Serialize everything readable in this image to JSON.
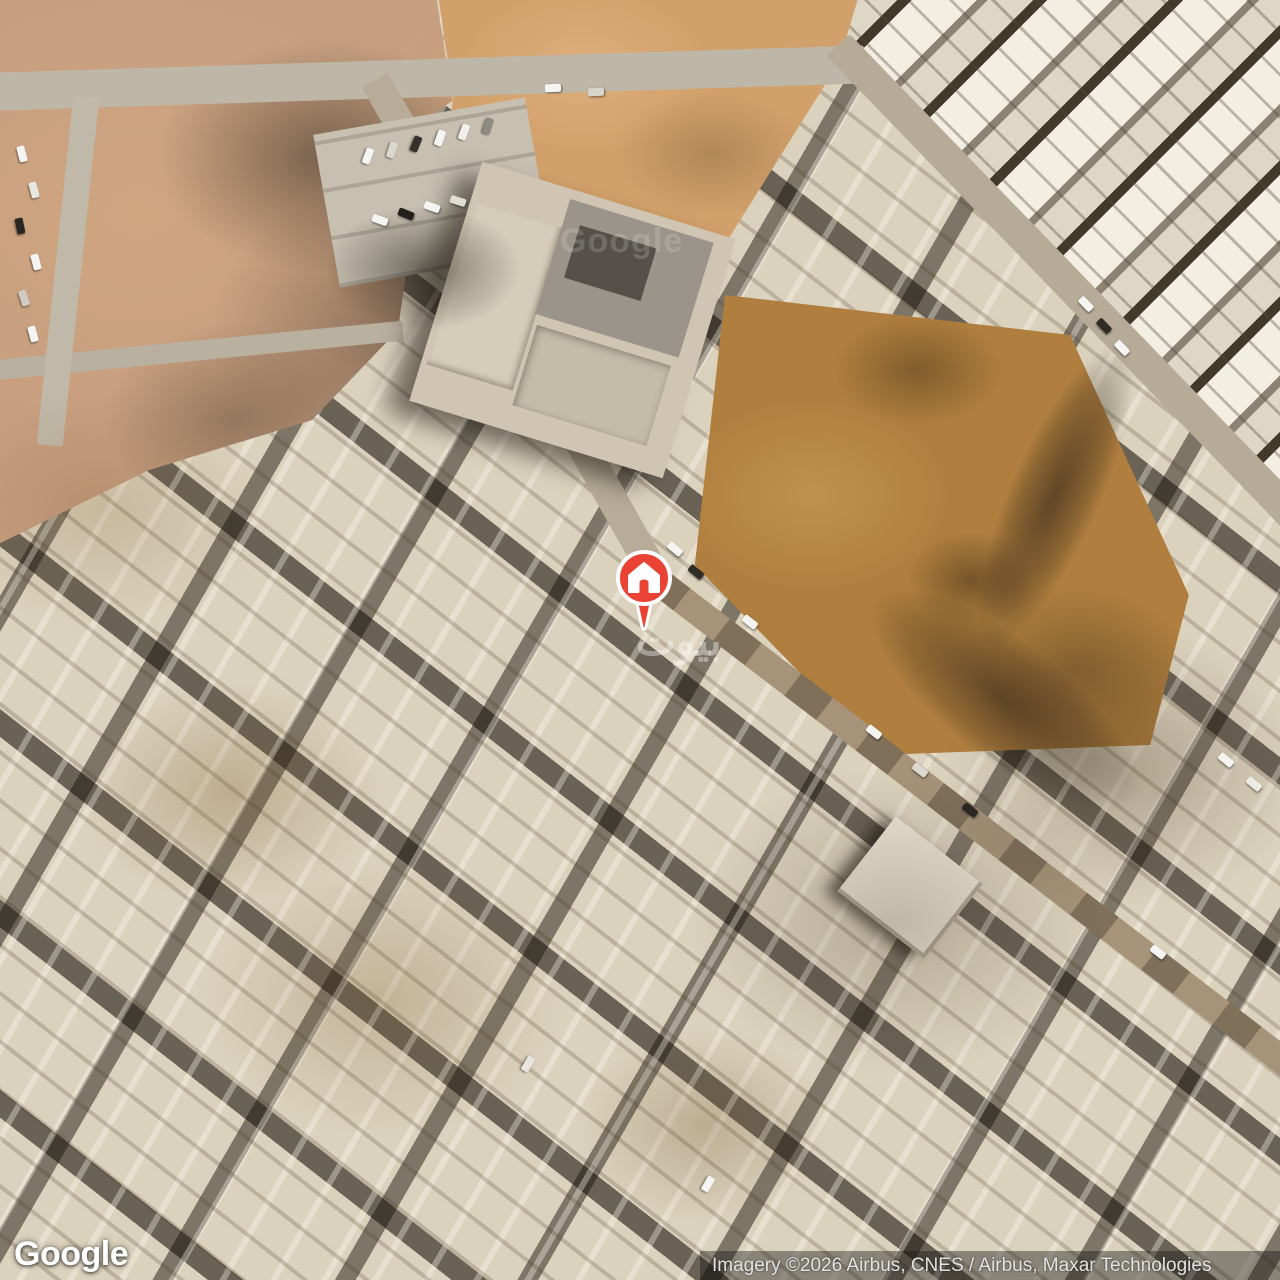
{
  "map": {
    "type": "satellite",
    "watermark": "بيوت",
    "tile_watermark": "Google"
  },
  "marker": {
    "icon": "home-pin",
    "color": "#EA4335"
  },
  "branding": {
    "logo_text": "Google"
  },
  "attribution": {
    "text": "Imagery ©2026 Airbus, CNES / Airbus, Maxar Technologies"
  },
  "decor": {
    "cars": [
      {
        "x": 14,
        "y": 150,
        "r": 75,
        "c": "#f4f4f2"
      },
      {
        "x": 26,
        "y": 186,
        "r": 75,
        "c": "#e8e6e0"
      },
      {
        "x": 12,
        "y": 222,
        "r": 78,
        "c": "#2a2722"
      },
      {
        "x": 28,
        "y": 258,
        "r": 75,
        "c": "#f4f4f2"
      },
      {
        "x": 16,
        "y": 294,
        "r": 72,
        "c": "#cfcbc2"
      },
      {
        "x": 25,
        "y": 330,
        "r": 75,
        "c": "#f4f4f2"
      },
      {
        "x": 360,
        "y": 152,
        "r": 110,
        "c": "#f4f4f2"
      },
      {
        "x": 384,
        "y": 146,
        "r": 108,
        "c": "#dad7cf"
      },
      {
        "x": 408,
        "y": 140,
        "r": 112,
        "c": "#35322c"
      },
      {
        "x": 432,
        "y": 134,
        "r": 110,
        "c": "#f4f4f2"
      },
      {
        "x": 456,
        "y": 128,
        "r": 110,
        "c": "#f1efe9"
      },
      {
        "x": 480,
        "y": 122,
        "r": 108,
        "c": "#8f8b82"
      },
      {
        "x": 372,
        "y": 216,
        "r": 20,
        "c": "#f4f4f2"
      },
      {
        "x": 398,
        "y": 210,
        "r": 22,
        "c": "#23201b"
      },
      {
        "x": 424,
        "y": 203,
        "r": 20,
        "c": "#f4f4f2"
      },
      {
        "x": 450,
        "y": 197,
        "r": 18,
        "c": "#e0ddd5"
      },
      {
        "x": 545,
        "y": 84,
        "r": -2,
        "c": "#f4f4f2"
      },
      {
        "x": 588,
        "y": 88,
        "r": -2,
        "c": "#d8d5cd"
      },
      {
        "x": 1078,
        "y": 300,
        "r": 46,
        "c": "#f4f4f2"
      },
      {
        "x": 1096,
        "y": 322,
        "r": 46,
        "c": "#2e2b25"
      },
      {
        "x": 1114,
        "y": 344,
        "r": 46,
        "c": "#f4f4f2"
      },
      {
        "x": 667,
        "y": 545,
        "r": 40,
        "c": "#f4f4f2"
      },
      {
        "x": 688,
        "y": 568,
        "r": 40,
        "c": "#302d27"
      },
      {
        "x": 742,
        "y": 618,
        "r": 38,
        "c": "#f4f4f2"
      },
      {
        "x": 866,
        "y": 728,
        "r": 38,
        "c": "#f4f4f2"
      },
      {
        "x": 912,
        "y": 766,
        "r": 38,
        "c": "#ddd9d0"
      },
      {
        "x": 962,
        "y": 806,
        "r": 38,
        "c": "#2b2823"
      },
      {
        "x": 1218,
        "y": 756,
        "r": 40,
        "c": "#f4f4f2"
      },
      {
        "x": 1246,
        "y": 780,
        "r": 40,
        "c": "#eceae4"
      },
      {
        "x": 1150,
        "y": 948,
        "r": 38,
        "c": "#f4f4f2"
      },
      {
        "x": 700,
        "y": 1180,
        "r": 120,
        "c": "#f4f4f2"
      },
      {
        "x": 520,
        "y": 1060,
        "r": 120,
        "c": "#e8e5de"
      }
    ]
  }
}
